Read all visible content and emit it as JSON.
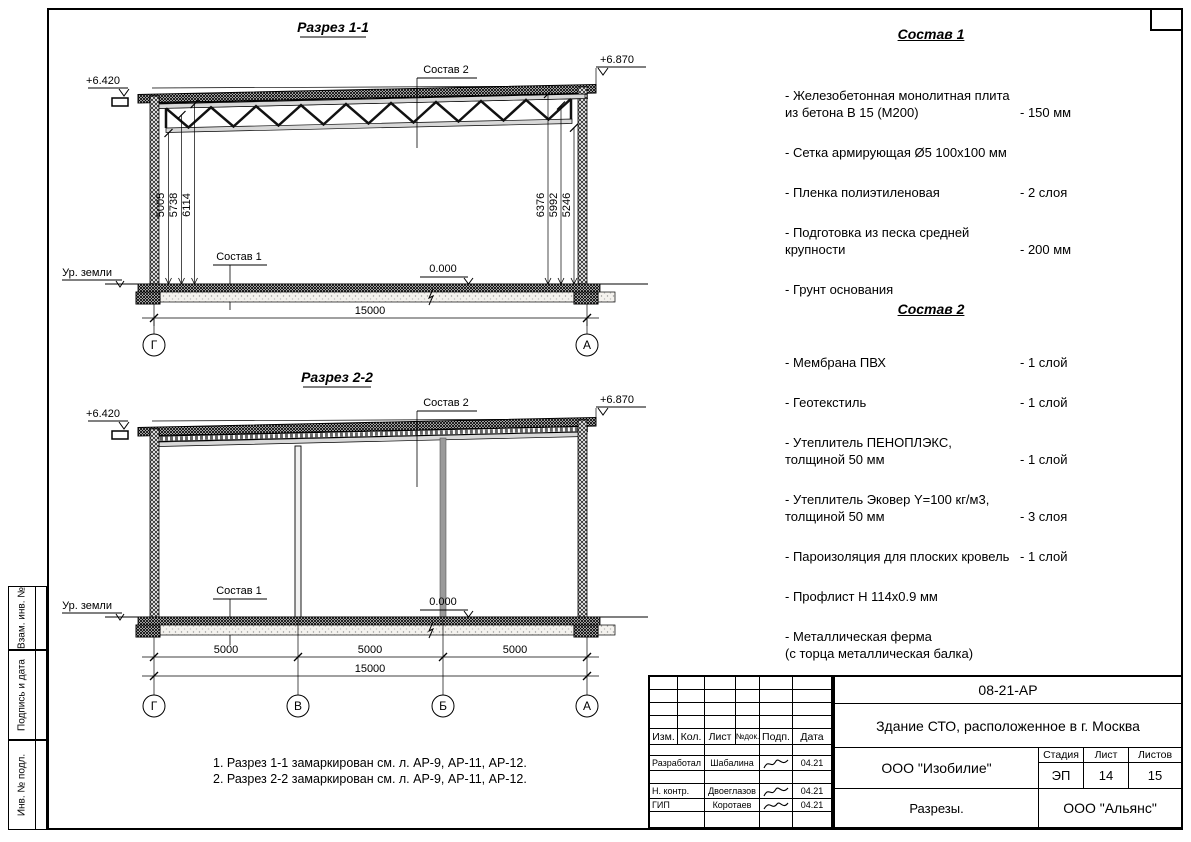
{
  "sections": {
    "s1": {
      "title": "Разрез 1-1",
      "elev_left": "+6.420",
      "elev_right": "+6.870",
      "sostav2_label": "Состав 2",
      "sostav1_label": "Состав 1",
      "zero_level": "0.000",
      "ground_label": "Ур. земли",
      "dims_left": [
        "5005",
        "5738",
        "6114"
      ],
      "dims_right": [
        "6376",
        "5992",
        "5246"
      ],
      "total_dim": "15000",
      "axes": [
        "Г",
        "А"
      ]
    },
    "s2": {
      "title": "Разрез 2-2",
      "elev_left": "+6.420",
      "elev_right": "+6.870",
      "sostav2_label": "Состав 2",
      "sostav1_label": "Состав 1",
      "zero_level": "0.000",
      "ground_label": "Ур. земли",
      "span_dims": [
        "5000",
        "5000",
        "5000"
      ],
      "total_dim": "15000",
      "axes": [
        "Г",
        "В",
        "Б",
        "А"
      ]
    }
  },
  "sostav1": {
    "title": "Состав 1",
    "items": [
      {
        "line1": "- Железобетонная  монолитная плита",
        "line2": "из бетона В 15 (М200)",
        "value": "- 150 мм"
      },
      {
        "line1": "- Сетка армирующая Ø5 100х100 мм",
        "value": ""
      },
      {
        "line1": "- Пленка полиэтиленовая",
        "value": "-  2 слоя"
      },
      {
        "line1": "- Подготовка из песка средней",
        "line2": "крупности",
        "value": "- 200 мм"
      },
      {
        "line1": "- Грунт основания",
        "value": ""
      }
    ]
  },
  "sostav2": {
    "title": "Состав 2",
    "items": [
      {
        "line1": "- Мембрана ПВХ",
        "value": "- 1 слой"
      },
      {
        "line1": "- Геотекстиль",
        "value": "- 1 слой"
      },
      {
        "line1": "- Утеплитель ПЕНОПЛЭКС,",
        "line2": "толщиной 50 мм",
        "value": "- 1 слой"
      },
      {
        "line1": "- Утеплитель Эковер Y=100 кг/м3,",
        "line2": "толщиной 50 мм",
        "value": "- 3 слоя"
      },
      {
        "line1": "- Пароизоляция для плоских кровель",
        "value": "- 1 слой"
      },
      {
        "line1": "- Профлист Н 114х0.9 мм",
        "value": ""
      },
      {
        "line1": "- Металлическая ферма",
        "line2": "(с торца металлическая балка)",
        "value": ""
      }
    ]
  },
  "notes": [
    "1. Разрез 1-1 замаркирован см. л. АР-9, АР-11, АР-12.",
    "2. Разрез 2-2 замаркирован см. л. АР-9, АР-11, АР-12."
  ],
  "titleblock": {
    "doc_number": "08-21-АР",
    "project_title": "Здание СТО, расположенное в г. Москва",
    "header": [
      "Изм.",
      "Кол.",
      "Лист",
      "№док.",
      "Подп.",
      "Дата"
    ],
    "sign_rows": [
      {
        "role": "Разработал",
        "name": "Шабалина",
        "date": "04.21"
      },
      {
        "role": "Н. контр.",
        "name": "Двоеглазов",
        "date": "04.21"
      },
      {
        "role": "ГИП",
        "name": "Коротаев",
        "date": "04.21"
      }
    ],
    "org": "ООО \"Изобилие\"",
    "sheet_name": "Разрезы.",
    "org2": "ООО \"Альянс\"",
    "stage_label": "Стадия",
    "list_label": "Лист",
    "lists_label": "Листов",
    "stage": "ЭП",
    "list": "14",
    "lists": "15"
  },
  "margin_labels": [
    "Взам. инв. №",
    "Подпись и дата",
    "Инв. № подл."
  ]
}
